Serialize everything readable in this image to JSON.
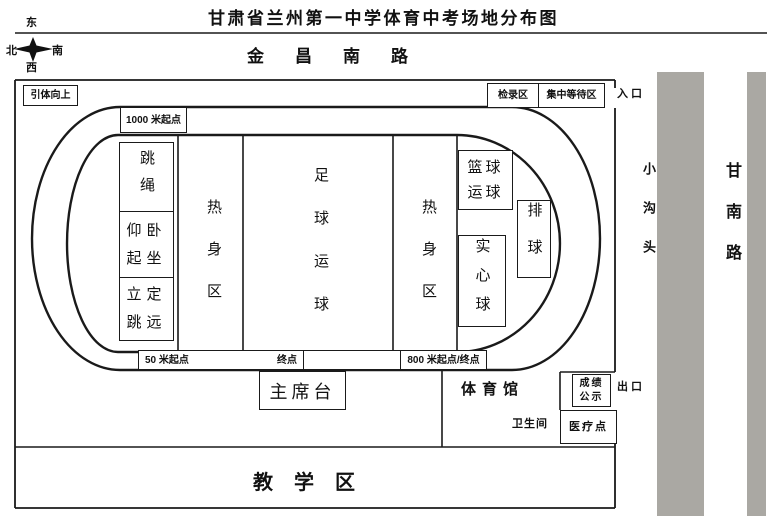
{
  "title": "甘肃省兰州第一中学体育中考场地分布图",
  "compass": {
    "east": "东",
    "north": "北",
    "south": "南",
    "west": "西"
  },
  "roads": {
    "jinchang": "金昌南路",
    "gannan": "甘南路",
    "xiaogoutou": "小沟头"
  },
  "gates": {
    "entrance": "入 口",
    "exit": "出 口"
  },
  "facilities": {
    "pull_up": "引体向上",
    "check_in": "检录区",
    "waiting_area": "集中等待区"
  },
  "track": {
    "start_1000m": "1000 米起点",
    "start_50m": "50 米起点",
    "finish": "终点",
    "start_finish_800m": "800 米起点/终点"
  },
  "infield": {
    "rope_skipping": "跳绳",
    "sit_ups": "仰卧\n起坐",
    "standing_long_jump": "立定\n跳远",
    "warmup_left": "热身区",
    "football_dribble": "足球运球",
    "warmup_right": "热身区",
    "basketball_dribble": "篮球\n运球",
    "volleyball": "排球",
    "medicine_ball": "实心球"
  },
  "south": {
    "rostrum": "主席台",
    "gym": "体育馆",
    "restroom": "卫生间",
    "score_notice": "成绩\n公示",
    "medical": "医疗点"
  },
  "teaching_area": "教学区",
  "colors": {
    "line": "#1a1a1a",
    "road_bar": "#aaa8a3"
  }
}
